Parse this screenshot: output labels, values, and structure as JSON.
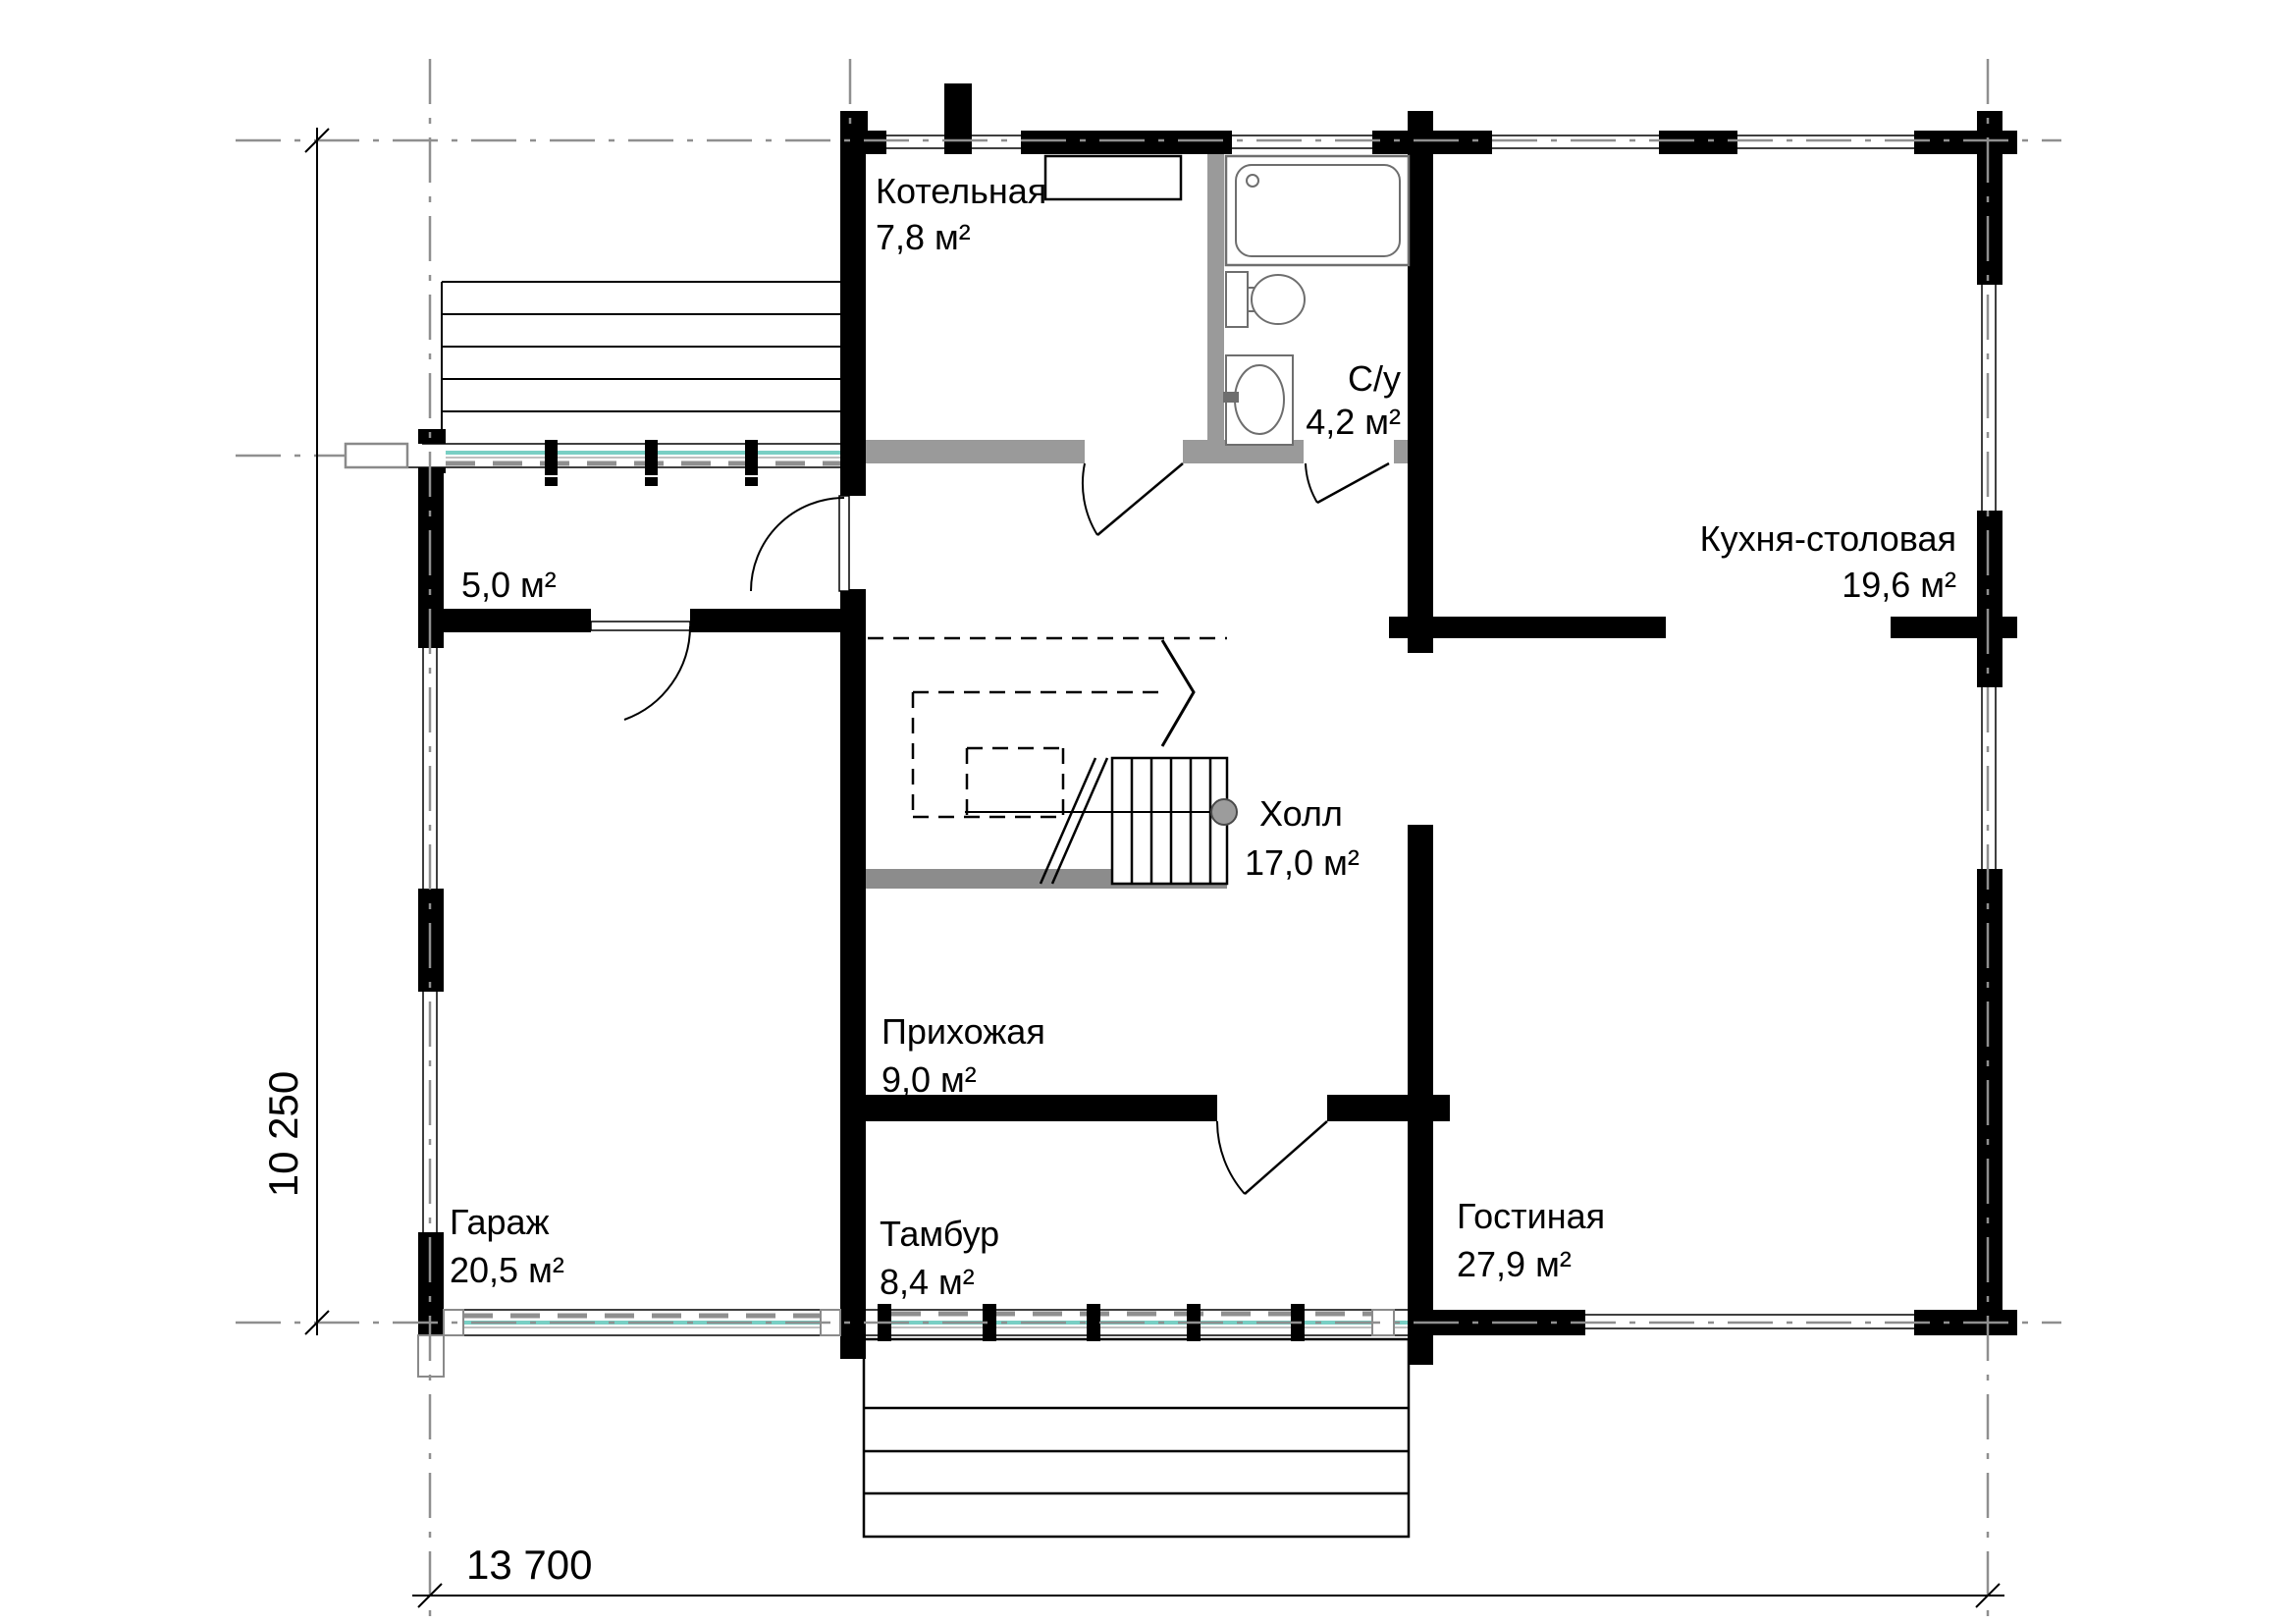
{
  "plan": {
    "rooms": [
      {
        "id": "boiler",
        "name": "Котельная",
        "area": "7,8 м²"
      },
      {
        "id": "bathroom",
        "name": "С/у",
        "area": "4,2 м²"
      },
      {
        "id": "kitchen_dining",
        "name": "Кухня-столовая",
        "area": "19,6 м²"
      },
      {
        "id": "storage",
        "name": "",
        "area": "5,0 м²"
      },
      {
        "id": "hall",
        "name": "Холл",
        "area": "17,0 м²"
      },
      {
        "id": "entry_hall",
        "name": "Прихожая",
        "area": "9,0 м²"
      },
      {
        "id": "garage",
        "name": "Гараж",
        "area": "20,5 м²"
      },
      {
        "id": "vestibule",
        "name": "Тамбур",
        "area": "8,4 м²"
      },
      {
        "id": "living_room",
        "name": "Гостиная",
        "area": "27,9 м²"
      }
    ],
    "dimensions": {
      "horizontal": "13 700",
      "vertical": "10 250"
    },
    "colors": {
      "walls": "#000000",
      "partitions": "#9a9a9a",
      "glazing": "#79cfc4",
      "centerlines": "#8f8f8f",
      "floor_strip": "#8c8c8c"
    }
  }
}
